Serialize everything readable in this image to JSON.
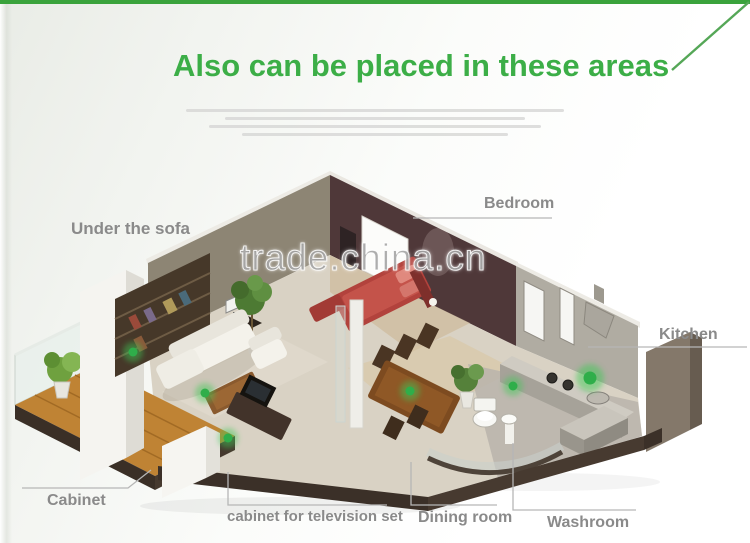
{
  "title": "Also can be placed in these areas",
  "watermark": "trade.china.cn",
  "accent_color": "#3cae47",
  "marker_color": "#2fae4a",
  "labels": {
    "under_sofa": "Under the sofa",
    "bedroom": "Bedroom",
    "kitchen": "Kitchen",
    "cabinet": "Cabinet",
    "tv_cabinet": "cabinet for television set",
    "dining_room": "Dining room",
    "washroom": "Washroom"
  }
}
